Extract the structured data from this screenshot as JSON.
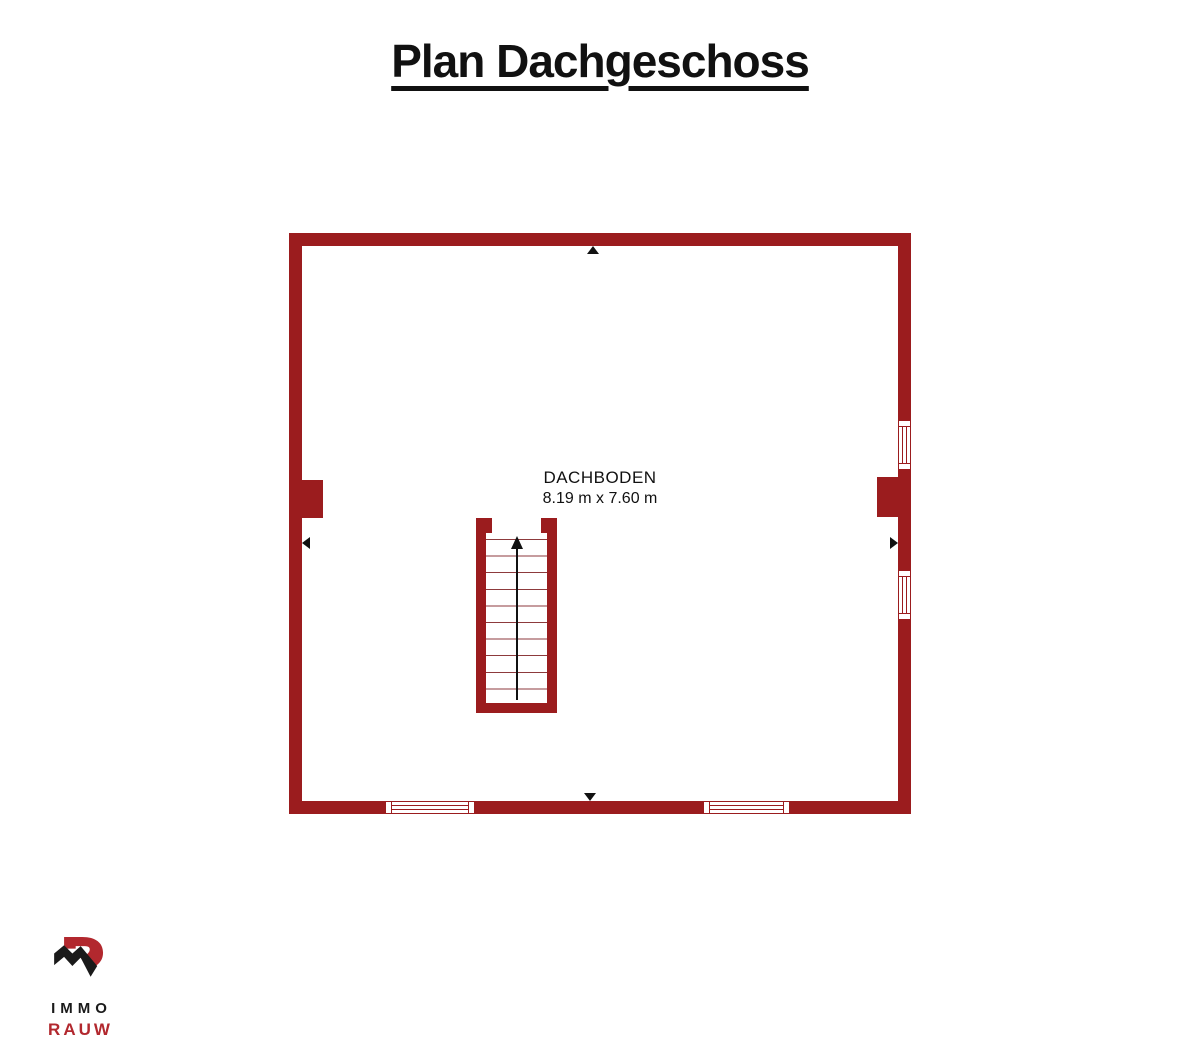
{
  "title": "Plan Dachgeschoss",
  "room": {
    "name": "DACHBODEN",
    "size": "8.19 m x 7.60 m"
  },
  "logo": {
    "line1": "IMMO",
    "line2": "RAUW"
  },
  "icons": {
    "wall-marker-top": "triangle-up",
    "wall-marker-bottom": "triangle-down",
    "wall-marker-left": "triangle-left",
    "wall-marker-right": "triangle-right",
    "stair-direction": "arrow-up",
    "logo-mark": "house-roof-with-r-monogram"
  },
  "colors": {
    "wall": "#9B1C1E",
    "stair_tread": "#8d3a3c",
    "text": "#111111",
    "logo_black": "#1a1a1a",
    "logo_red": "#B2282E",
    "background": "#ffffff"
  }
}
